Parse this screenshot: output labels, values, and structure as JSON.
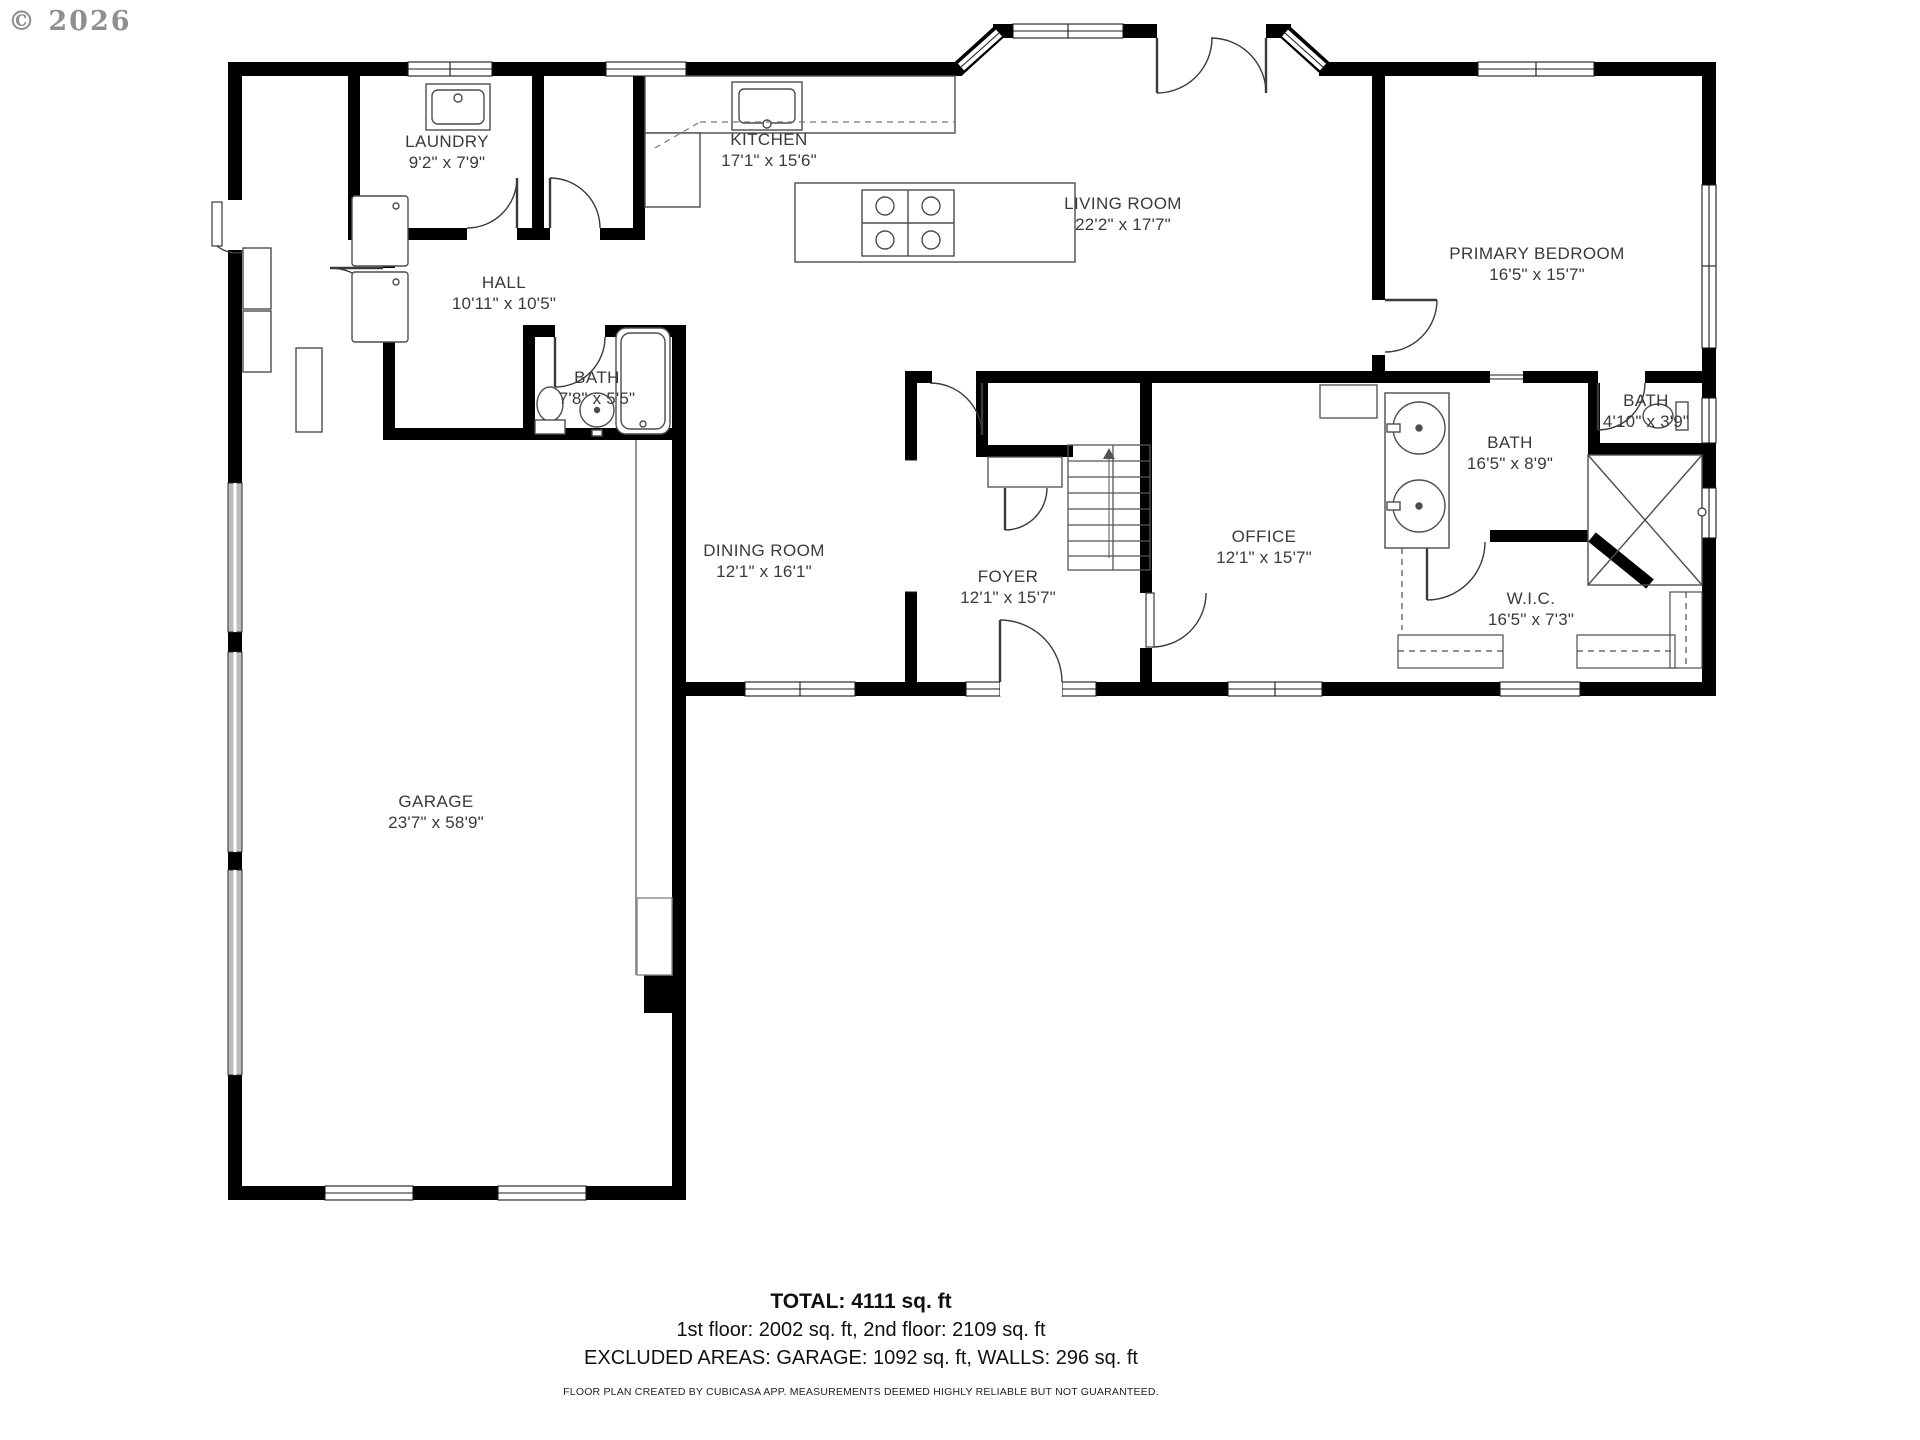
{
  "copyright": "© 2026",
  "rooms": [
    {
      "id": "laundry",
      "label": "LAUNDRY",
      "dims": "9'2\" x 7'9\""
    },
    {
      "id": "kitchen",
      "label": "KITCHEN",
      "dims": "17'1\" x 15'6\""
    },
    {
      "id": "living",
      "label": "LIVING ROOM",
      "dims": "22'2\" x 17'7\""
    },
    {
      "id": "primary",
      "label": "PRIMARY BEDROOM",
      "dims": "16'5\" x 15'7\""
    },
    {
      "id": "hall",
      "label": "HALL",
      "dims": "10'11\" x 10'5\""
    },
    {
      "id": "bath1",
      "label": "BATH",
      "dims": "7'8\" x 5'5\""
    },
    {
      "id": "dining",
      "label": "DINING ROOM",
      "dims": "12'1\" x 16'1\""
    },
    {
      "id": "foyer",
      "label": "FOYER",
      "dims": "12'1\" x 15'7\""
    },
    {
      "id": "office",
      "label": "OFFICE",
      "dims": "12'1\" x 15'7\""
    },
    {
      "id": "bath2",
      "label": "BATH",
      "dims": "16'5\" x 8'9\""
    },
    {
      "id": "bath3",
      "label": "BATH",
      "dims": "4'10\" x 3'9\""
    },
    {
      "id": "wic",
      "label": "W.I.C.",
      "dims": "16'5\" x 7'3\""
    },
    {
      "id": "garage",
      "label": "GARAGE",
      "dims": "23'7\" x 58'9\""
    }
  ],
  "summary": {
    "total": "TOTAL: 4111 sq. ft",
    "floors": "1st floor: 2002 sq. ft, 2nd floor: 2109 sq. ft",
    "excluded": "EXCLUDED AREAS: GARAGE: 1092 sq. ft, WALLS: 296 sq. ft",
    "disclaimer": "FLOOR PLAN CREATED BY CUBICASA APP. MEASUREMENTS DEEMED HIGHLY RELIABLE BUT NOT GUARANTEED."
  }
}
